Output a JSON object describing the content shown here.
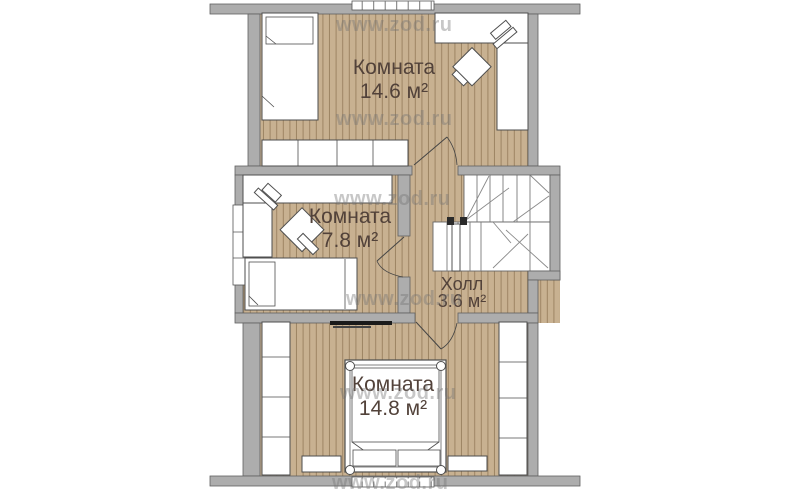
{
  "plan": {
    "rooms": {
      "top": {
        "name": "Комната",
        "area": "14.6 м²"
      },
      "middle": {
        "name": "Комната",
        "area": "7.8 м²"
      },
      "hall": {
        "name": "Холл",
        "area": "3.6 м²"
      },
      "bottom": {
        "name": "Комната",
        "area": "14.8 м²"
      }
    }
  },
  "watermark": {
    "text": "www.zod.ru"
  },
  "colors": {
    "floor": "#c8b191",
    "floor_line": "rgba(122,95,62,.55)",
    "wall": "#adadad",
    "wall_edge": "#606060",
    "label": "#52423a",
    "outline": "#4e4e4e",
    "wm": "rgba(115,115,115,.40)"
  }
}
